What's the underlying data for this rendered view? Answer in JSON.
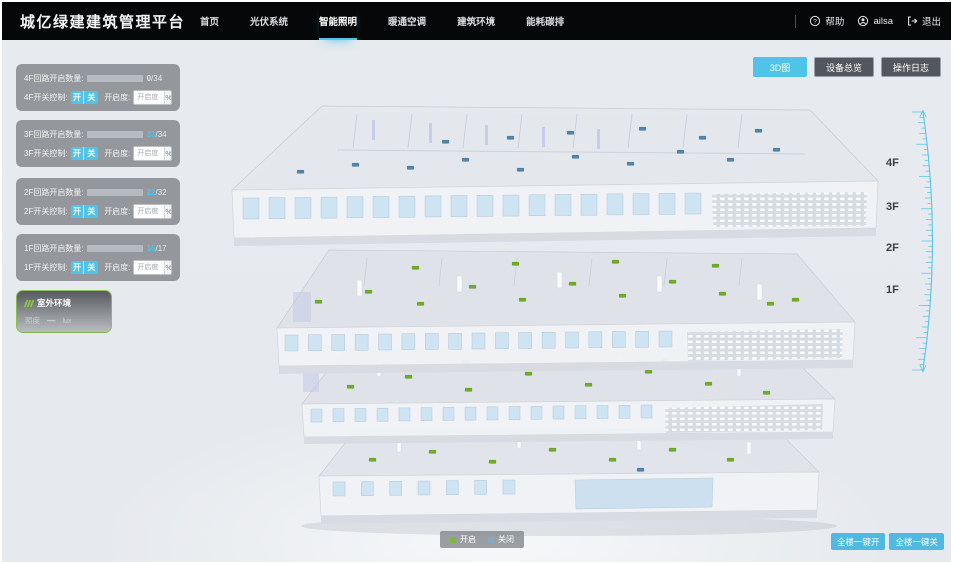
{
  "header": {
    "title": "城亿绿建建筑管理平台",
    "nav": [
      {
        "label": "首页",
        "active": false
      },
      {
        "label": "光伏系统",
        "active": false
      },
      {
        "label": "智能照明",
        "active": true
      },
      {
        "label": "暖通空调",
        "active": false
      },
      {
        "label": "建筑环境",
        "active": false
      },
      {
        "label": "能耗碳排",
        "active": false
      }
    ],
    "help_label": "帮助",
    "username": "ailsa",
    "logout_label": "退出"
  },
  "view_toolbar": {
    "buttons": [
      {
        "label": "3D图",
        "active": true
      },
      {
        "label": "设备总览",
        "active": false
      },
      {
        "label": "操作日志",
        "active": false
      }
    ]
  },
  "floor_panels": [
    {
      "floor": "4F",
      "circuit_label": "4F回路开启数量:",
      "open": 0,
      "total": 34,
      "open_text": "0",
      "total_text": "/34",
      "switch_label": "4F开关控制:",
      "on_label": "开",
      "off_label": "关",
      "dim_label": "开启度:",
      "dim_placeholder": "开启度",
      "percent_label": "%"
    },
    {
      "floor": "3F",
      "circuit_label": "3F回路开启数量:",
      "open": 33,
      "total": 34,
      "open_text": "33",
      "total_text": "/34",
      "switch_label": "3F开关控制:",
      "on_label": "开",
      "off_label": "关",
      "dim_label": "开启度:",
      "dim_placeholder": "开启度",
      "percent_label": "%"
    },
    {
      "floor": "2F",
      "circuit_label": "2F回路开启数量:",
      "open": 22,
      "total": 32,
      "open_text": "22",
      "total_text": "/32",
      "switch_label": "2F开关控制:",
      "on_label": "开",
      "off_label": "关",
      "dim_label": "开启度:",
      "dim_placeholder": "开启度",
      "percent_label": "%"
    },
    {
      "floor": "1F",
      "circuit_label": "1F回路开启数量:",
      "open": 16,
      "total": 17,
      "open_text": "16",
      "total_text": "/17",
      "switch_label": "1F开关控制:",
      "on_label": "开",
      "off_label": "关",
      "dim_label": "开启度:",
      "dim_placeholder": "开启度",
      "percent_label": "%"
    }
  ],
  "outdoor_panel": {
    "title": "室外环境",
    "metric_label": "照度",
    "metric_value": "—",
    "metric_unit": "lux"
  },
  "floor_labels": [
    "4F",
    "3F",
    "2F",
    "1F"
  ],
  "legend": {
    "items": [
      {
        "label": "开启",
        "color": "#7CB93E"
      },
      {
        "label": "关闭",
        "color": "#85A9C5"
      }
    ]
  },
  "bottom_actions": [
    {
      "label": "全楼一键开"
    },
    {
      "label": "全楼一键关"
    }
  ],
  "colors": {
    "accent": "#4FC3E8",
    "marker_open": "#6CAE26",
    "marker_closed": "#4E86AE"
  }
}
